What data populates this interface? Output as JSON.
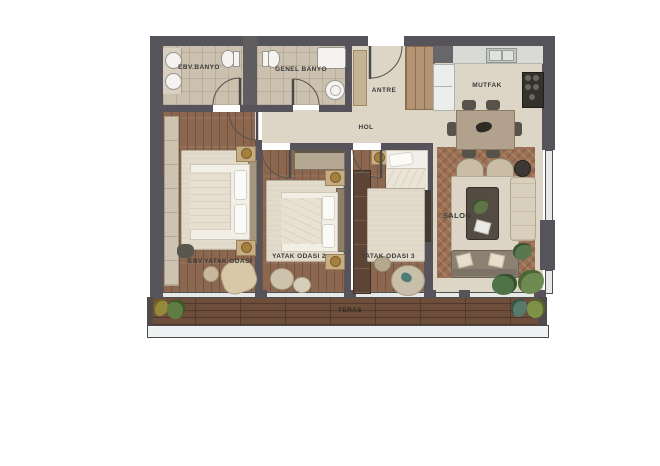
{
  "plan": {
    "type": "apartment-floor-plan",
    "labels": {
      "ebv_banyo": "EBV.BANYO",
      "genel_banyo": "GENEL BANYO",
      "antre": "ANTRE",
      "mutfak": "MUTFAK",
      "hol": "HOL",
      "ebv_yatak_odasi": "EBV.YATAK ODASI",
      "yatak_odasi_2": "YATAK ODASI 2",
      "yatak_odasi_3": "YATAK ODASI 3",
      "salon": "SALON",
      "teras": "TERAS"
    },
    "colors": {
      "wall": "#56545a",
      "tile_floor": "#cbc1ae",
      "wood_floor": "#8b6750",
      "hall_floor": "#ddd6c6",
      "salon_floor": "#9b7054",
      "terrace_floor": "#6d4e3a",
      "rug": "#e2dbcc",
      "background": "#ffffff"
    }
  }
}
